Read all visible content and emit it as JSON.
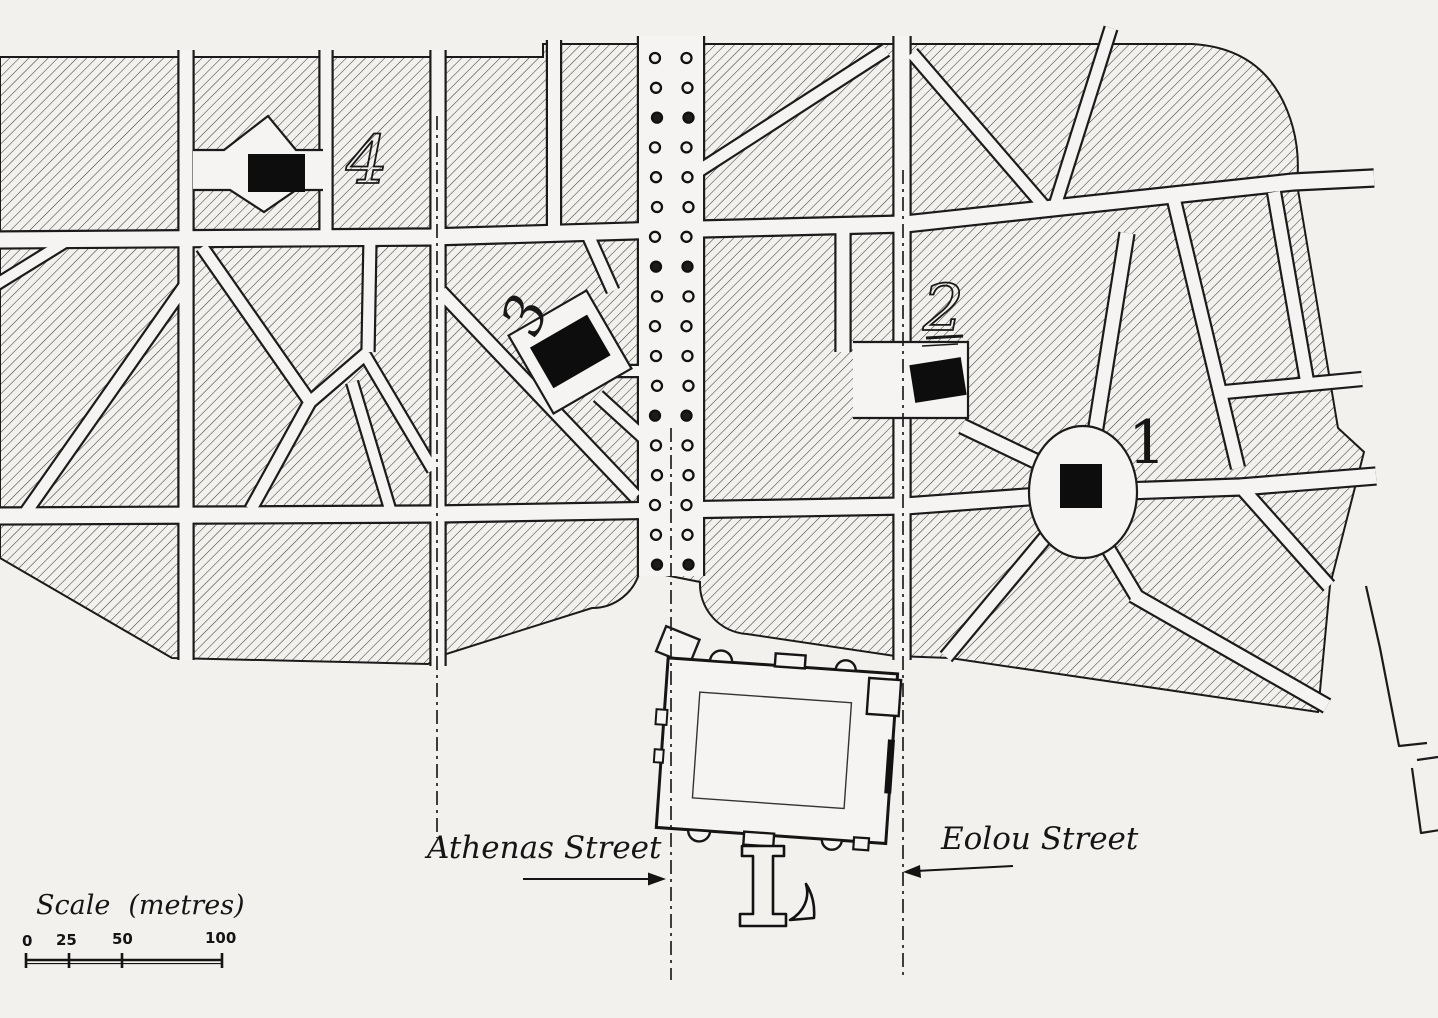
{
  "labels": {
    "athenas": "Athenas Street",
    "eolou": "Eolou Street"
  },
  "markers": {
    "m1": "1",
    "m2": "2",
    "m3": "3",
    "m4": "4"
  },
  "central_monument_glyph": "L",
  "scale_bar": {
    "label_word": "Scale",
    "label_unit": "(metres)",
    "ticks": [
      "0",
      "25",
      "50",
      "100"
    ]
  },
  "icons": {
    "tree-icon": "small circle (street tree)",
    "axis-icon": "dash-dot street axis line",
    "arrow-icon": "street pointer arrow"
  },
  "colors": {
    "paper": "#f2f1ee",
    "street": "#f5f4f2",
    "ink": "#1b1b1b",
    "hatch": "#3b3831",
    "marker_black": "#0d0d0d"
  },
  "trees": {
    "column_x": [
      656,
      687.5
    ],
    "y_start": 58,
    "y_step": 29.8,
    "count": 18,
    "radius": 5
  }
}
